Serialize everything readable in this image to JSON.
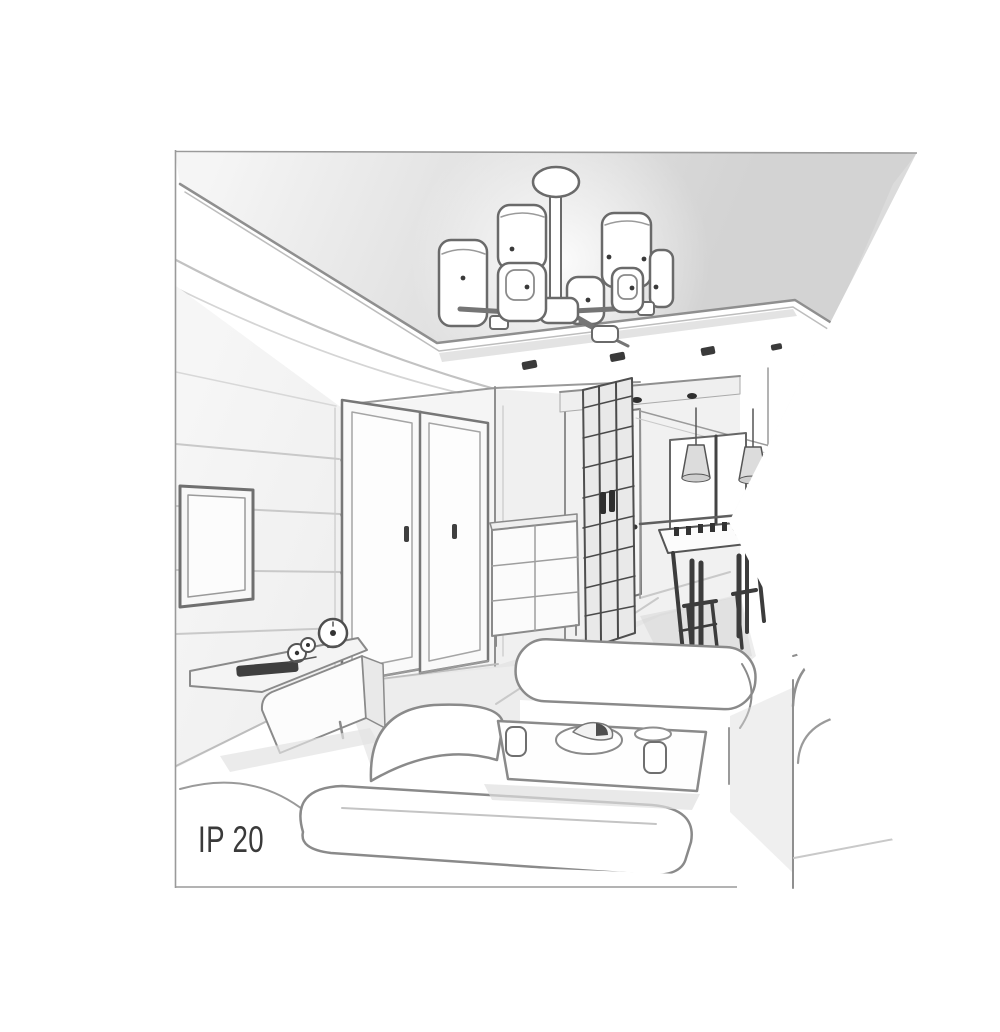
{
  "figure": {
    "kind": "interior-room-line-drawing",
    "annotation": {
      "ip_rating": "IP 20"
    },
    "colors": {
      "background": "#ffffff",
      "ink": "#6f6f6f",
      "ink_mid": "#8f8f8f",
      "ink_dark": "#3a3a3a",
      "ink_light": "#c9c9c9",
      "panel_wash": "#d9d9d9",
      "floor_wash": "#dcdcdc",
      "label": "#3a3a3a"
    },
    "scene": {
      "items": [
        "ceiling-chandelier",
        "chandelier-shades",
        "drop-ceiling-panel",
        "recessed-spotlights",
        "wall-tv",
        "tv-sideboard",
        "table-clock",
        "decor-figurine",
        "remote-bar",
        "interior-door-1",
        "interior-door-2",
        "drawer-chest",
        "lattice-wardrobe",
        "hallway-door",
        "kitchen-window",
        "pendant-lights",
        "dining-table",
        "dining-chairs",
        "left-sofa",
        "center-sofa",
        "right-sofa",
        "coffee-table",
        "cup",
        "serving-plate",
        "drinking-glass",
        "ip-rating-label"
      ]
    }
  }
}
